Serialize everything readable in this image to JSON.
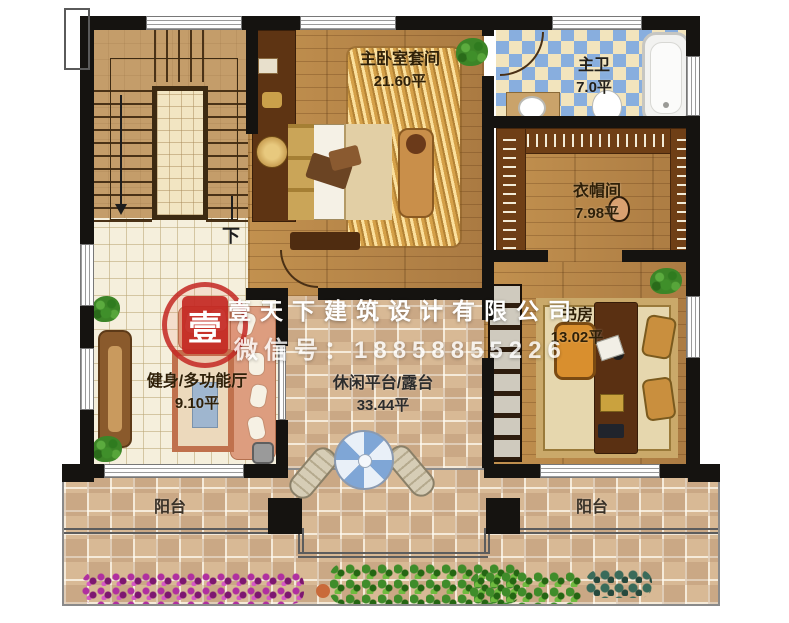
{
  "rooms": {
    "master_bedroom": {
      "name": "主卧室套间",
      "area": "21.60平"
    },
    "master_bath": {
      "name": "主卫",
      "area": "7.0平"
    },
    "closet": {
      "name": "衣帽间",
      "area": "7.98平"
    },
    "study": {
      "name": "书房",
      "area": "13.02平"
    },
    "gym": {
      "name": "健身/多功能厅",
      "area": "9.10平"
    },
    "terrace": {
      "name": "休闲平台/露台",
      "area": "33.44平"
    },
    "balcony_left": {
      "name": "阳台"
    },
    "balcony_right": {
      "name": "阳台"
    }
  },
  "stair": {
    "direction_label": "下"
  },
  "watermark": {
    "company": "壹天下建筑设计有限公司",
    "contact": "微信号：18858855226",
    "seal_character": "壹"
  },
  "colors": {
    "wall": "#151310",
    "wood_floor": "#b5854e",
    "tile_floor": "#f5efdc",
    "bath_tile_blue": "#88aede",
    "terrace_mosaic": "#d8b995",
    "stamp_red": "#c32823",
    "sofa_salmon": "#dd9d7f",
    "umbrella_blue": "#7fa6d6"
  }
}
